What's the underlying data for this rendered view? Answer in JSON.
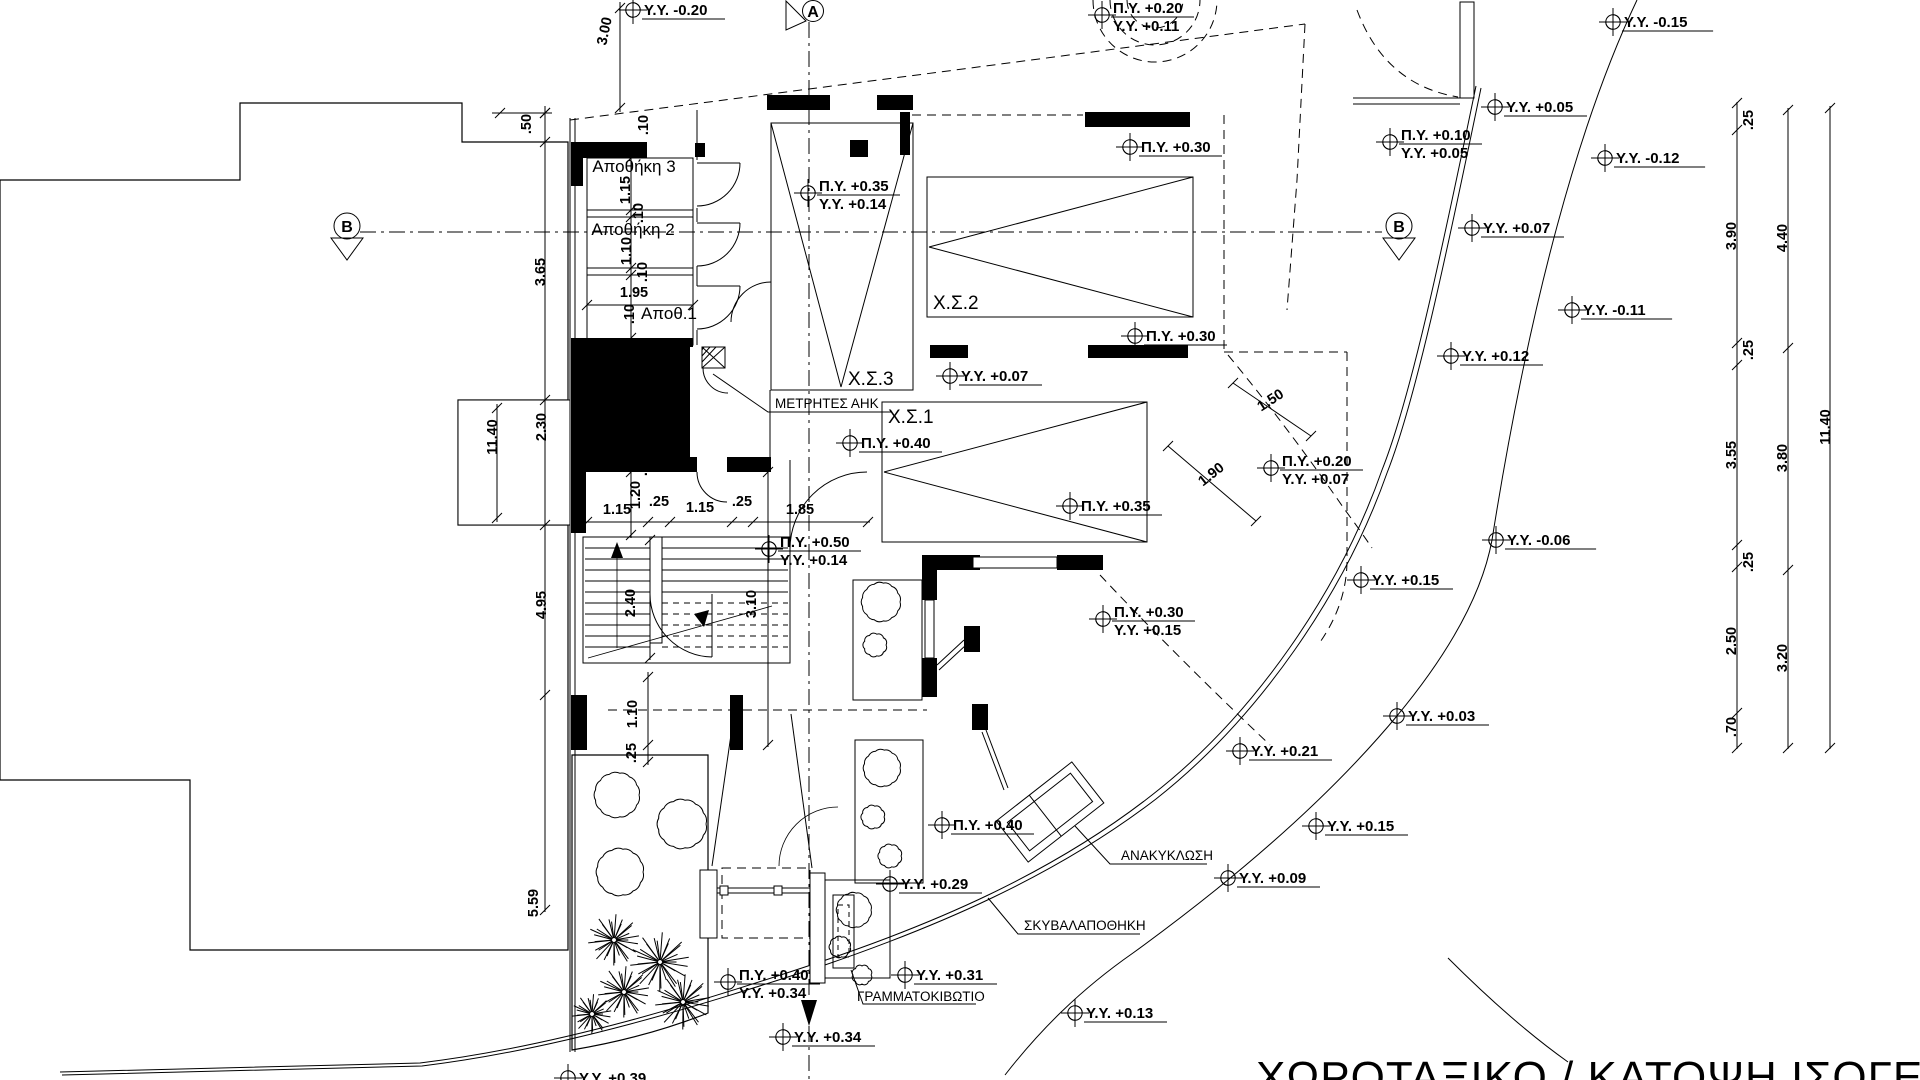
{
  "drawing": {
    "title": "ΧΩΡΟΤΑΞΙΚΟ / ΚΑΤΟΨΗ ΙΣΟΓΕΙΟΥ"
  },
  "section_markers": [
    {
      "label": "A",
      "x": 813,
      "y": 11
    },
    {
      "label": "B",
      "x": 347,
      "y": 226
    },
    {
      "label": "B",
      "x": 1399,
      "y": 226
    }
  ],
  "rooms": [
    {
      "label": "Αποθήκη 3",
      "x": 634,
      "y": 172,
      "cls": "room",
      "anchor": "middle"
    },
    {
      "label": "Αποθήκη 2",
      "x": 633,
      "y": 235,
      "cls": "room",
      "anchor": "middle"
    },
    {
      "label": "Αποθ.1",
      "x": 669,
      "y": 319,
      "cls": "room",
      "anchor": "middle"
    },
    {
      "label": "Χ.Σ.3",
      "x": 848,
      "y": 385,
      "cls": "park",
      "anchor": "start"
    },
    {
      "label": "Χ.Σ.2",
      "x": 933,
      "y": 309,
      "cls": "park",
      "anchor": "start"
    },
    {
      "label": "Χ.Σ.1",
      "x": 888,
      "y": 423,
      "cls": "park",
      "anchor": "start"
    },
    {
      "label": "ΜΕΤΡΗΤΕΣ ΑΗΚ",
      "x": 775,
      "y": 408,
      "cls": "ann",
      "anchor": "start"
    }
  ],
  "annotations": [
    {
      "label": "ΑΝΑΚΥΚΛΩΣΗ",
      "x": 1121,
      "y": 860
    },
    {
      "label": "ΣΚΥΒΑΛΑΠΟΘΗΚΗ",
      "x": 1024,
      "y": 930
    },
    {
      "label": "ΓΡΑΜΜΑΤΟΚΙΒΩΤΙΟ",
      "x": 857,
      "y": 1001
    }
  ],
  "elevation_markers": [
    {
      "x": 633,
      "y": 10,
      "lines": [
        "Υ.Υ. -0.20"
      ]
    },
    {
      "x": 1102,
      "y": 15,
      "lines": [
        "Π.Υ. +0.20",
        "Υ.Υ. +0.11"
      ]
    },
    {
      "x": 1613,
      "y": 22,
      "lines": [
        "Υ.Υ.  -0.15"
      ]
    },
    {
      "x": 1495,
      "y": 107,
      "lines": [
        "Υ.Υ. +0.05"
      ]
    },
    {
      "x": 1130,
      "y": 147,
      "lines": [
        "Π.Υ. +0.30"
      ]
    },
    {
      "x": 1390,
      "y": 142,
      "lines": [
        "Π.Υ. +0.10",
        "Υ.Υ. +0.05"
      ]
    },
    {
      "x": 1605,
      "y": 158,
      "lines": [
        "Υ.Υ.  -0.12"
      ]
    },
    {
      "x": 808,
      "y": 193,
      "lines": [
        "Π.Υ. +0.35",
        "Υ.Υ. +0.14"
      ]
    },
    {
      "x": 1472,
      "y": 228,
      "lines": [
        "Υ.Υ. +0.07"
      ]
    },
    {
      "x": 1572,
      "y": 310,
      "lines": [
        "Υ.Υ.  -0.11"
      ]
    },
    {
      "x": 1451,
      "y": 356,
      "lines": [
        "Υ.Υ. +0.12"
      ]
    },
    {
      "x": 950,
      "y": 376,
      "lines": [
        "Υ.Υ. +0.07"
      ]
    },
    {
      "x": 1135,
      "y": 336,
      "lines": [
        "Π.Υ. +0.30"
      ]
    },
    {
      "x": 850,
      "y": 443,
      "lines": [
        "Π.Υ. +0.40"
      ]
    },
    {
      "x": 1271,
      "y": 468,
      "lines": [
        "Π.Υ. +0.20",
        "Υ.Υ. +0.07"
      ]
    },
    {
      "x": 1070,
      "y": 506,
      "lines": [
        "Π.Υ. +0.35"
      ]
    },
    {
      "x": 769,
      "y": 549,
      "lines": [
        "Π.Υ. +0.50",
        "Υ.Υ. +0.14"
      ]
    },
    {
      "x": 1103,
      "y": 619,
      "lines": [
        "Π.Υ. +0.30",
        "Υ.Υ. +0.15"
      ]
    },
    {
      "x": 1496,
      "y": 540,
      "lines": [
        "Υ.Υ.  -0.06"
      ]
    },
    {
      "x": 1361,
      "y": 580,
      "lines": [
        "Υ.Υ. +0.15"
      ]
    },
    {
      "x": 1240,
      "y": 751,
      "lines": [
        "Υ.Υ. +0.21"
      ]
    },
    {
      "x": 1397,
      "y": 716,
      "lines": [
        "Υ.Υ. +0.03"
      ]
    },
    {
      "x": 942,
      "y": 825,
      "lines": [
        "Π.Υ. +0.40"
      ]
    },
    {
      "x": 890,
      "y": 884,
      "lines": [
        "Υ.Υ. +0.29"
      ]
    },
    {
      "x": 1228,
      "y": 878,
      "lines": [
        "Υ.Υ. +0.09"
      ]
    },
    {
      "x": 1316,
      "y": 826,
      "lines": [
        "Υ.Υ. +0.15"
      ]
    },
    {
      "x": 1075,
      "y": 1013,
      "lines": [
        "Υ.Υ. +0.13"
      ]
    },
    {
      "x": 905,
      "y": 975,
      "lines": [
        "Υ.Υ. +0.31"
      ]
    },
    {
      "x": 728,
      "y": 982,
      "lines": [
        "Π.Υ. +0.40",
        "Υ.Υ. +0.34"
      ]
    },
    {
      "x": 783,
      "y": 1037,
      "lines": [
        "Υ.Υ. +0.34"
      ]
    },
    {
      "x": 568,
      "y": 1078,
      "lines": [
        "Υ.Υ. +0.39"
      ]
    }
  ],
  "dimensions": [
    {
      "text": ".50",
      "x": 531,
      "y": 124,
      "rot": -90
    },
    {
      "text": "3.00",
      "x": 609,
      "y": 32,
      "rot": -78
    },
    {
      "text": "3.65",
      "x": 545,
      "y": 272,
      "rot": -90
    },
    {
      "text": "2.30",
      "x": 546,
      "y": 427,
      "rot": -90
    },
    {
      "text": "11.40",
      "x": 497,
      "y": 437,
      "rot": -90
    },
    {
      "text": "4.95",
      "x": 546,
      "y": 605,
      "rot": -90
    },
    {
      "text": "5.59",
      "x": 538,
      "y": 903,
      "rot": -90
    },
    {
      "text": ".10",
      "x": 648,
      "y": 125,
      "rot": -90
    },
    {
      "text": "1.15",
      "x": 630,
      "y": 190,
      "rot": -90
    },
    {
      "text": ".10",
      "x": 643,
      "y": 213,
      "rot": -90
    },
    {
      "text": "1.10",
      "x": 631,
      "y": 251,
      "rot": -90
    },
    {
      "text": ".10",
      "x": 647,
      "y": 272,
      "rot": -90
    },
    {
      "text": "1.95",
      "x": 634,
      "y": 297,
      "rot": 0
    },
    {
      "text": ".10",
      "x": 634,
      "y": 314,
      "rot": -90
    },
    {
      "text": "1.80",
      "x": 638,
      "y": 377,
      "rot": 0
    },
    {
      "text": "1.80",
      "x": 634,
      "y": 430,
      "rot": -90
    },
    {
      "text": ".25",
      "x": 647,
      "y": 466,
      "rot": -90
    },
    {
      "text": "1.20",
      "x": 640,
      "y": 495,
      "rot": -90
    },
    {
      "text": "1.15",
      "x": 617,
      "y": 514,
      "rot": 0
    },
    {
      "text": ".25",
      "x": 659,
      "y": 506,
      "rot": 0
    },
    {
      "text": "1.15",
      "x": 700,
      "y": 512,
      "rot": 0
    },
    {
      "text": ".25",
      "x": 742,
      "y": 506,
      "rot": 0
    },
    {
      "text": "1.85",
      "x": 800,
      "y": 514,
      "rot": 0
    },
    {
      "text": "2.40",
      "x": 635,
      "y": 603,
      "rot": -90
    },
    {
      "text": "3.10",
      "x": 756,
      "y": 604,
      "rot": -90
    },
    {
      "text": "1.10",
      "x": 637,
      "y": 714,
      "rot": -90
    },
    {
      "text": ".25",
      "x": 636,
      "y": 753,
      "rot": -90
    },
    {
      "text": "1.50",
      "x": 1273,
      "y": 404,
      "rot": -33
    },
    {
      "text": "1.90",
      "x": 1214,
      "y": 478,
      "rot": -38
    },
    {
      "text": ".25",
      "x": 1753,
      "y": 120,
      "rot": -90
    },
    {
      "text": "3.90",
      "x": 1736,
      "y": 236,
      "rot": -90
    },
    {
      "text": ".25",
      "x": 1753,
      "y": 350,
      "rot": -90
    },
    {
      "text": "3.55",
      "x": 1736,
      "y": 455,
      "rot": -90
    },
    {
      "text": ".25",
      "x": 1753,
      "y": 562,
      "rot": -90
    },
    {
      "text": "2.50",
      "x": 1736,
      "y": 641,
      "rot": -90
    },
    {
      "text": ".70",
      "x": 1736,
      "y": 727,
      "rot": -90
    },
    {
      "text": "4.40",
      "x": 1787,
      "y": 238,
      "rot": -90
    },
    {
      "text": "3.80",
      "x": 1787,
      "y": 458,
      "rot": -90
    },
    {
      "text": "3.20",
      "x": 1787,
      "y": 658,
      "rot": -90
    },
    {
      "text": "11.40",
      "x": 1830,
      "y": 427,
      "rot": -90
    }
  ]
}
